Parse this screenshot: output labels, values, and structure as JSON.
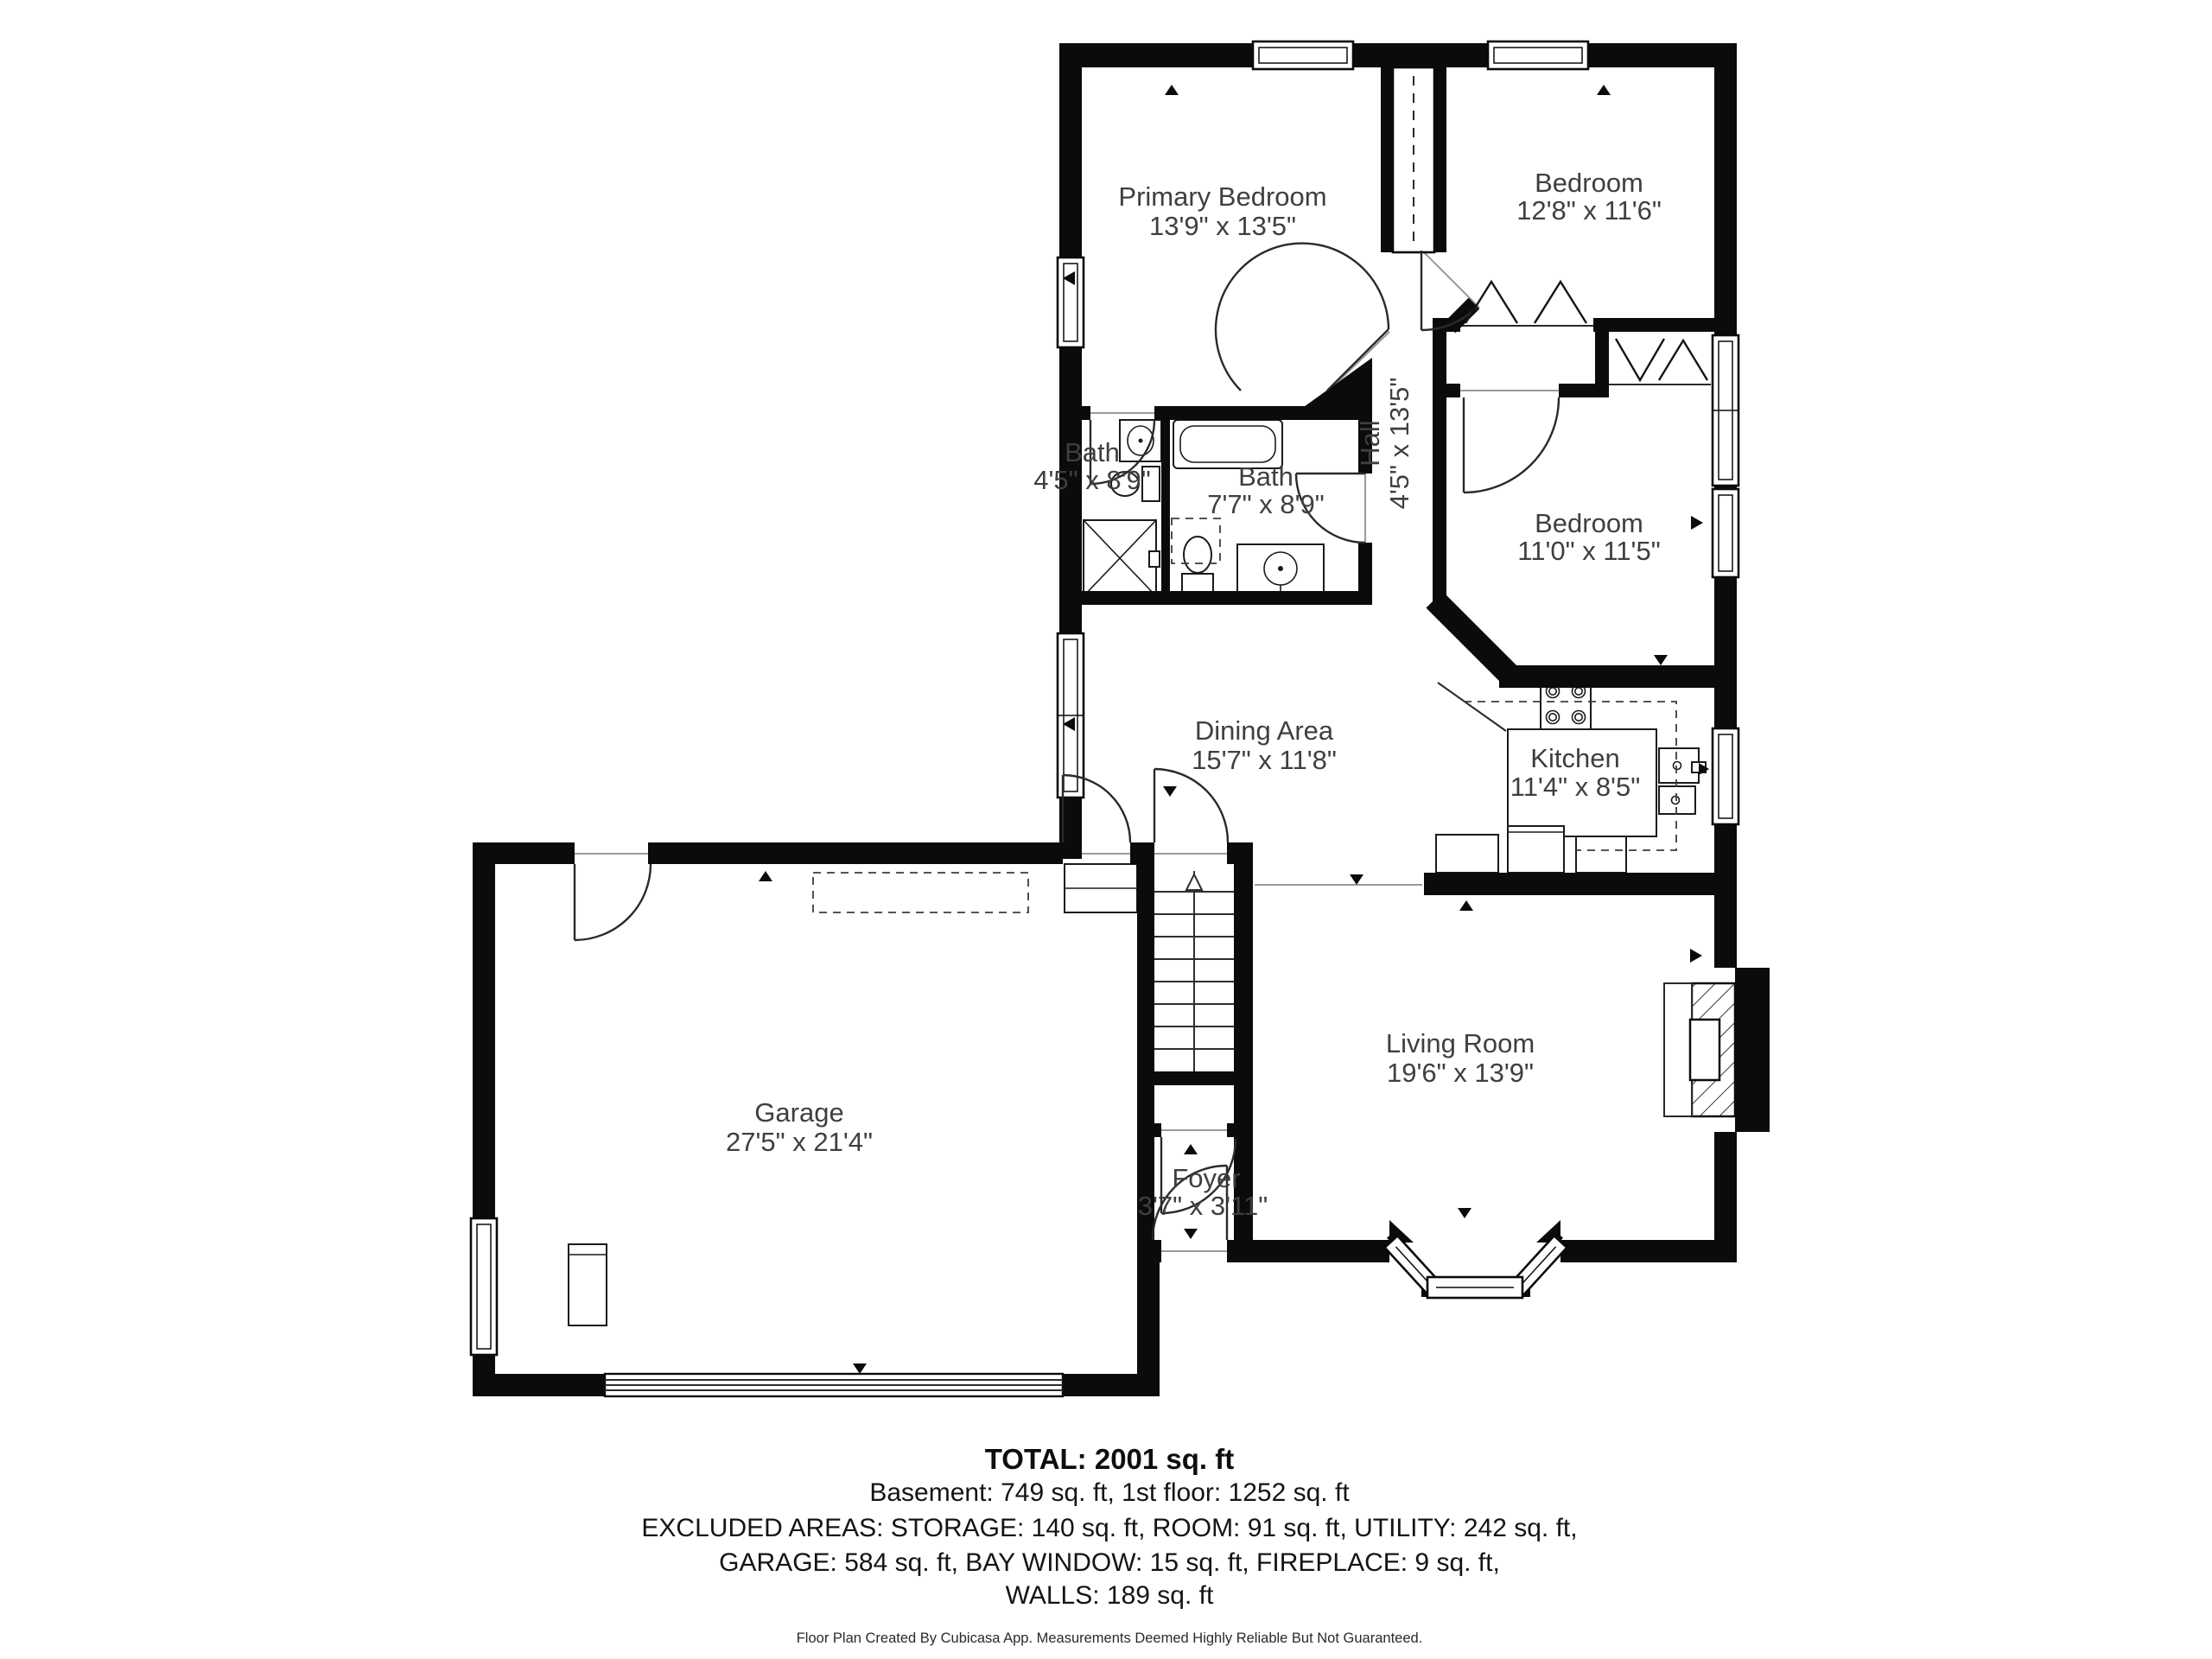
{
  "plan_title": "First floor plan",
  "rooms": [
    {
      "id": "primary-bedroom",
      "name": "Primary Bedroom",
      "dims": "13'9\" x 13'5\""
    },
    {
      "id": "bedroom-top",
      "name": "Bedroom",
      "dims": "12'8\" x 11'6\""
    },
    {
      "id": "bath-small",
      "name": "Bath",
      "dims": "4'5\" x 8'9\""
    },
    {
      "id": "bath-main",
      "name": "Bath",
      "dims": "7'7\" x 8'9\""
    },
    {
      "id": "hall",
      "name": "Hall",
      "dims": "4'5\" x 13'5\""
    },
    {
      "id": "bedroom-mid",
      "name": "Bedroom",
      "dims": "11'0\" x 11'5\""
    },
    {
      "id": "dining-area",
      "name": "Dining Area",
      "dims": "15'7\" x 11'8\""
    },
    {
      "id": "kitchen",
      "name": "Kitchen",
      "dims": "11'4\" x 8'5\""
    },
    {
      "id": "garage",
      "name": "Garage",
      "dims": "27'5\" x 21'4\""
    },
    {
      "id": "living-room",
      "name": "Living Room",
      "dims": "19'6\" x 13'9\""
    },
    {
      "id": "foyer",
      "name": "Foyer",
      "dims": "3'7\" x 3'11\""
    }
  ],
  "summary": {
    "total": "TOTAL: 2001 sq. ft",
    "lines": [
      "Basement: 749 sq. ft, 1st floor: 1252 sq. ft",
      "EXCLUDED AREAS: STORAGE: 140 sq. ft, ROOM: 91 sq. ft, UTILITY: 242 sq. ft,",
      "GARAGE: 584 sq. ft, BAY WINDOW: 15 sq. ft, FIREPLACE: 9 sq. ft,",
      "WALLS: 189 sq. ft"
    ],
    "footer": "Floor Plan Created By Cubicasa App. Measurements Deemed Highly Reliable But Not Guaranteed."
  },
  "colors": {
    "wall": "#0b0b0b",
    "label": "#3f3f3f",
    "text": "#141414"
  }
}
